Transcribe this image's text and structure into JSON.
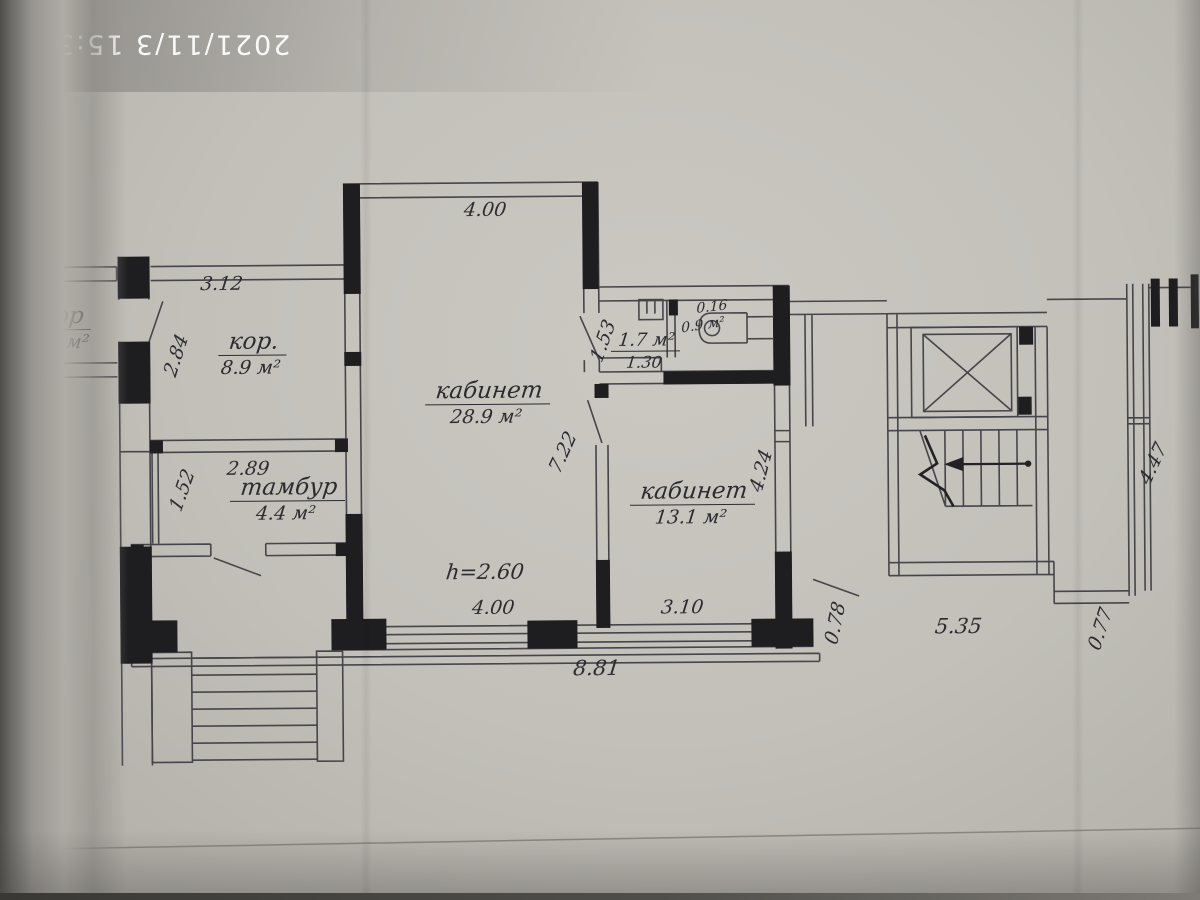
{
  "photo": {
    "timestamp": "2021/11/3 15:32"
  },
  "rooms": {
    "corridor_small": {
      "name": "кор",
      "area": "5.1 м²"
    },
    "corridor": {
      "name": "кор.",
      "area": "8.9 м²"
    },
    "tambour": {
      "name": "тамбур",
      "area": "4.4 м²"
    },
    "office_large": {
      "name": "кабинет",
      "area": "28.9 м²"
    },
    "office_small": {
      "name": "кабинет",
      "area": "13.1 м²"
    },
    "wc": {
      "area": "1.7 м²",
      "width": "1.30"
    },
    "wc_small": {
      "area": "0.9 м²",
      "width": "0.16"
    }
  },
  "dims": {
    "corridor_width": "3.12",
    "corridor_depth": "2.84",
    "tambour_side": "1.52",
    "tambour_width": "2.89",
    "office_top_width": "4.00",
    "office_right_depth": "7.22",
    "wc_door": "1.53",
    "office_small_depth": "4.24",
    "ceiling_height": "h=2.60",
    "office_bottom_width": "4.00",
    "office_small_width": "3.10",
    "building_width": "8.81",
    "gap_left": "0.78",
    "stair_block_width": "5.35",
    "gap_right": "0.77",
    "right_wing_depth": "4.47"
  }
}
